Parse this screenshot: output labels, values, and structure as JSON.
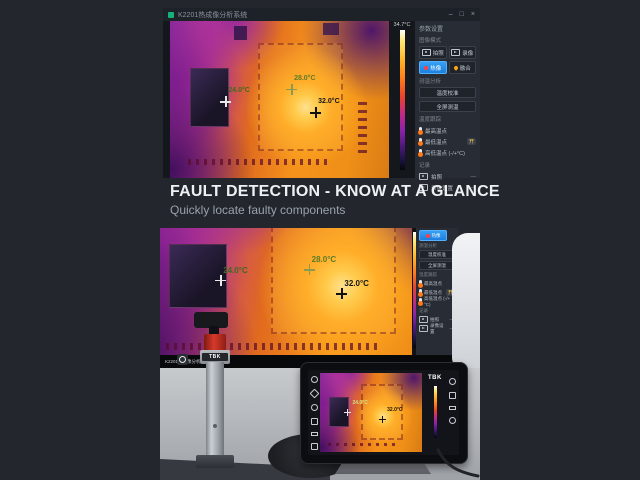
{
  "page": {
    "background": "#23272d"
  },
  "headline": {
    "title": "FAULT DETECTION - KNOW AT A GLANCE",
    "subtitle": "Quickly locate faulty components"
  },
  "app": {
    "title": "K2201热成像分析系统",
    "controls": {
      "minimize": "–",
      "maximize": "□",
      "close": "×"
    },
    "scale_max": "34.7°C",
    "markers": {
      "low": "24.0°C",
      "mid": "28.0°C",
      "high": "32.0°C"
    },
    "status_bar": "K2201热成像分析系统"
  },
  "sidebar": {
    "header": "参数设置",
    "mode_section": "图像模式",
    "modes": [
      {
        "label": "拍照"
      },
      {
        "label": "录像"
      },
      {
        "label": "热像"
      },
      {
        "label": "融合"
      }
    ],
    "tools_section": "测温分析",
    "tool_buttons": [
      "温度校准",
      "全屏测温"
    ],
    "temp_section": "温度跟踪",
    "temp_rows": [
      {
        "label": "最高温点"
      },
      {
        "label": "最低温点",
        "badge": "开"
      },
      {
        "label": "高低温点 (-/+°C)"
      }
    ],
    "record_section": "记录",
    "record_rows": [
      {
        "label": "拍照",
        "value": "—"
      },
      {
        "label": "录像设置",
        "value": "—"
      }
    ]
  },
  "scene": {
    "device_brand": "TBK",
    "tablet_brand": "TBK"
  },
  "colors": {
    "accent_blue": "#2f9bf4",
    "panel": "#282d35",
    "hot_orange": "#f5921c",
    "cold_purple": "#6b1e8c"
  }
}
